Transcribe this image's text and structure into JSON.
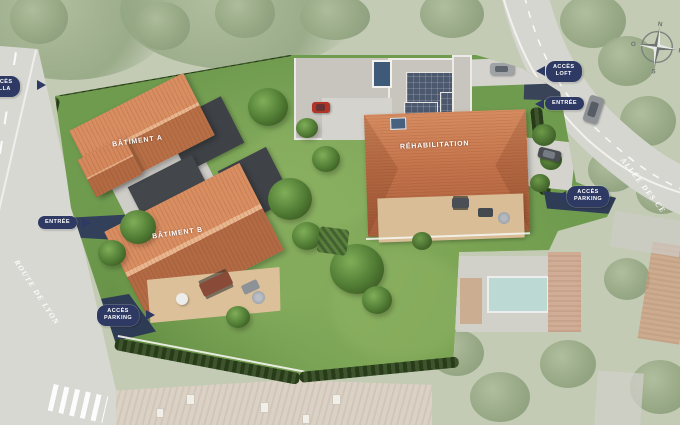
{
  "labels": {
    "batiment_a": "BÂTIMENT A",
    "batiment_b": "BÂTIMENT B",
    "rehabilitation": "RÉHABILITATION"
  },
  "badges": {
    "acces_villa": {
      "line1": "ACCÈS",
      "line2": "VILLA"
    },
    "entree_left": {
      "line1": "ENTRÉE"
    },
    "acces_parking_left": {
      "line1": "ACCÈS",
      "line2": "PARKING"
    },
    "acces_loft": {
      "line1": "ACCÈS",
      "line2": "LOFT"
    },
    "entree_right": {
      "line1": "ENTRÉE"
    },
    "acces_parking_right": {
      "line1": "ACCÈS",
      "line2": "PARKING"
    }
  },
  "streets": {
    "route_de_lyon": "ROUTE DE LYON",
    "allee_des_ce": "ALLÉE DES CE"
  },
  "compass": {
    "north": "N",
    "east": "E",
    "south": "S",
    "west": "O"
  },
  "colors": {
    "badge_navy": "#2e3a63",
    "roof_terracotta": "#c4744b",
    "flat_roof_charcoal": "#3e4246",
    "gravel_roof": "#c8c5bf",
    "solar_panel": "#4b586e",
    "lawn_green": "#6f9b4f",
    "hedge_green": "#31491f",
    "road_gray": "#d8d8d3",
    "driveway_navy": "#33405a",
    "terrace_tan": "#dcc09a",
    "pool_teal": "#bcd9d4",
    "faded_base": "#c3cbb4"
  }
}
